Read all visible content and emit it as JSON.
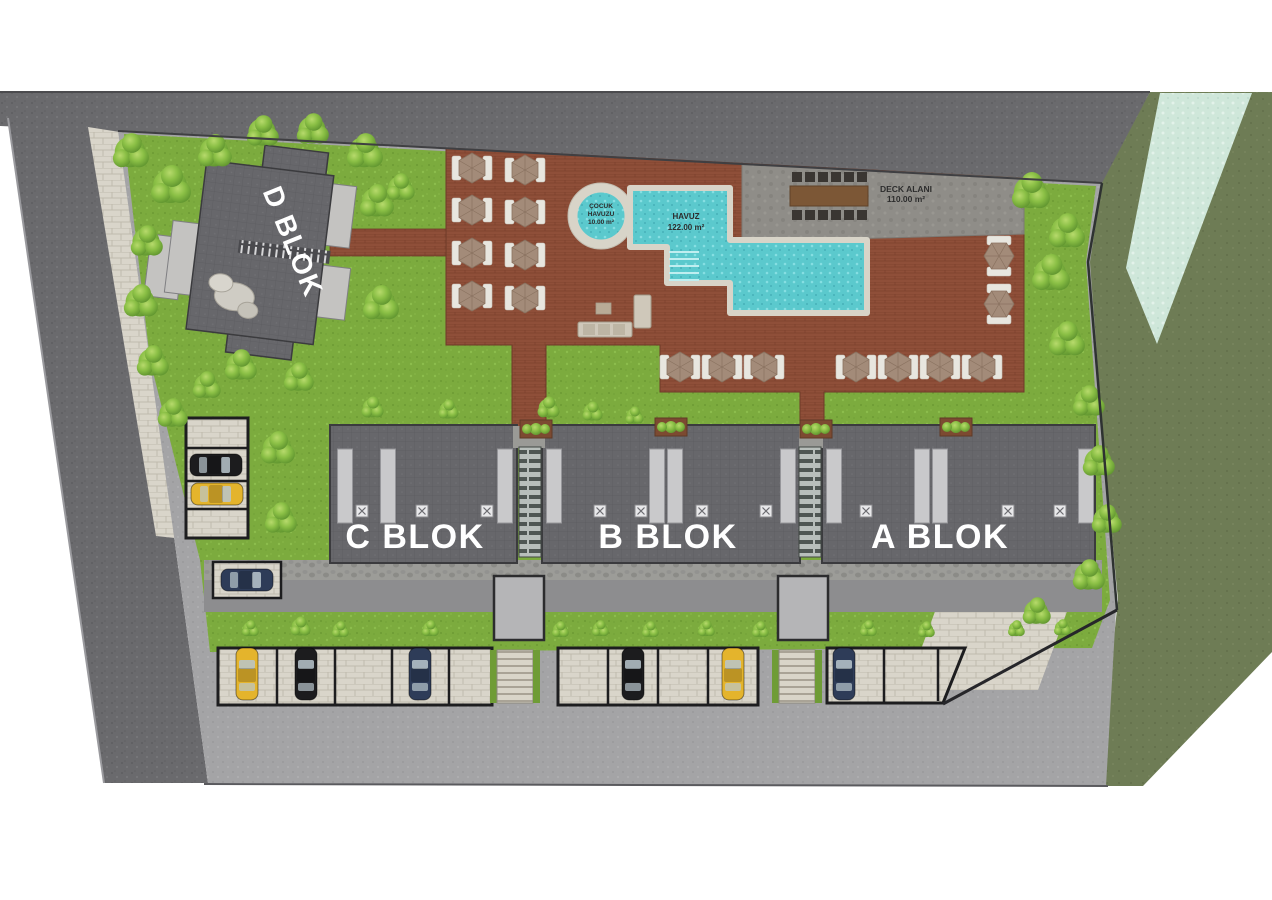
{
  "plan": {
    "blocks": {
      "a": "A BLOK",
      "b": "B BLOK",
      "c": "C BLOK",
      "d": "D BLOK"
    },
    "pool": {
      "kids_line1": "ÇOCUK",
      "kids_line2": "HAVUZU",
      "kids_area": "10.00 m²",
      "main_name": "HAVUZ",
      "main_area": "122.00 m²"
    },
    "deck": {
      "name": "DECK ALANI",
      "area": "110.00 m²"
    }
  },
  "colors": {
    "lawn": "#7cab3e",
    "outer_grass": "#6e7c55",
    "asphalt": "#6a6a6d",
    "pavement": "#a4a4a6",
    "stone": "#d9d5ca",
    "wood_deck": "#8f4f39",
    "stone_deck": "#8f8d88",
    "pool_water": "#5bc9cd",
    "stream": "#cfe7da",
    "roof": "#67676b",
    "car_yellow": "#e4b42c",
    "car_black": "#1c1c1e",
    "car_navy": "#2e3c58",
    "label_white": "#ffffff",
    "label_dark": "#2d2d2d"
  }
}
